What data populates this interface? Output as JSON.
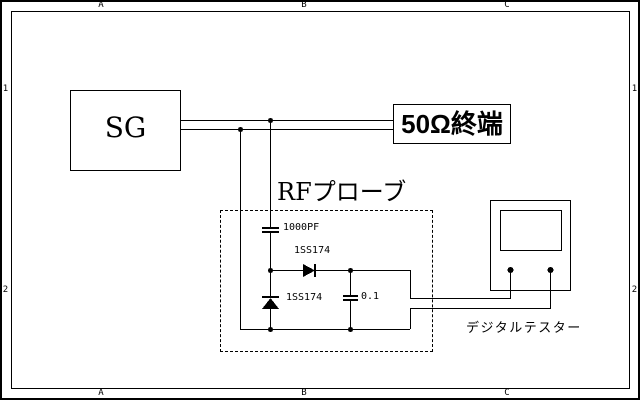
{
  "frame": {
    "column_labels": [
      "A",
      "B",
      "C"
    ],
    "row_labels": [
      "1",
      "2"
    ]
  },
  "signal_generator": {
    "label": "SG"
  },
  "termination": {
    "label": "50Ω終端"
  },
  "rf_probe": {
    "title": "RFプローブ",
    "coupling_capacitor": "1000PF",
    "series_diode": "1SS174",
    "shunt_diode": "1SS174",
    "filter_capacitor": "0.1"
  },
  "tester": {
    "label": "デジタルテスター"
  },
  "colors": {
    "line": "#000000",
    "background": "#ffffff"
  }
}
